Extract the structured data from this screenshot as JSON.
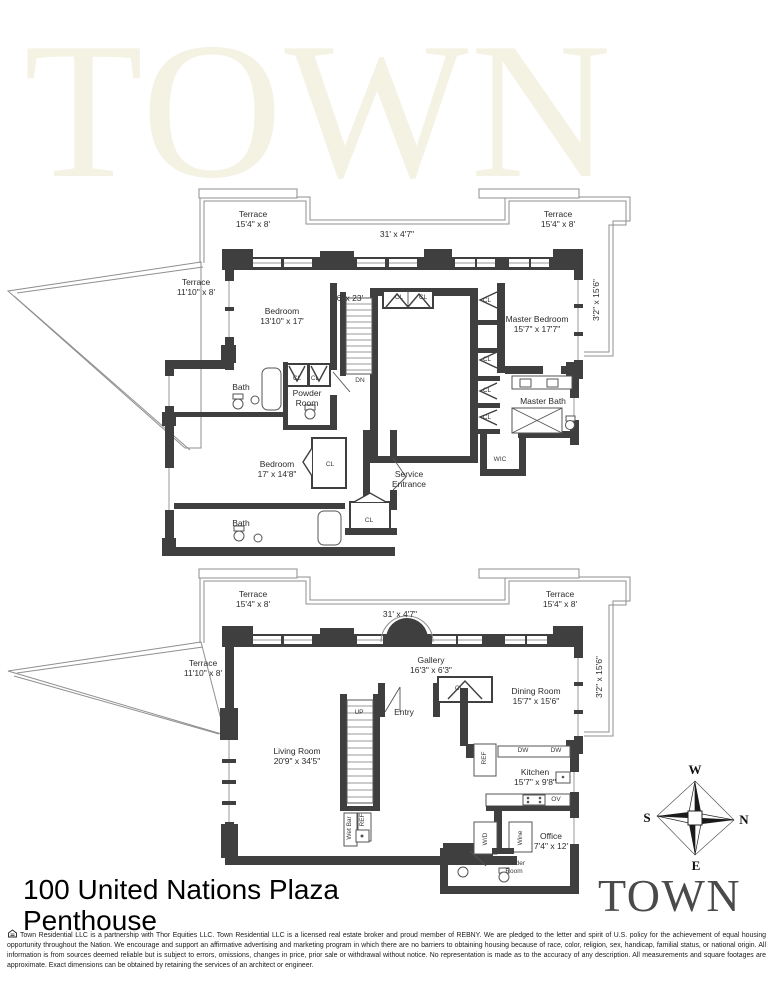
{
  "watermark": "TOWN",
  "colors": {
    "wall": "#3f3f3f",
    "outline": "#8f8f8f",
    "watermark": "#f4f2e3",
    "logo": "#4a4a4a"
  },
  "compass": {
    "top": "W",
    "left": "S",
    "right": "N",
    "bottom": "E"
  },
  "footer": {
    "address": "100 United Nations Plaza",
    "unit": "Penthouse",
    "logo": "TOWN",
    "disclaimer": "Town Residential LLC is a partnership with Thor Equities LLC. Town Residential LLC is a licensed real estate broker and proud member of REBNY. We are pledged to the letter and spirit of U.S. policy for the achievement of equal housing opportunity throughout the Nation. We encourage and support an affirmative advertising and marketing program in which there are no barriers to obtaining housing because of race, color, religion, sex, handicap, familial status, or national origin. All information is from sources deemed reliable but is subject to errors, omissions, changes in price, prior sale or withdrawal without notice. No representation is made as to the accuracy of any description. All measurements and square footages are approximate. Exact dimensions can be obtained by retaining the services of an architect or engineer."
  },
  "floors": {
    "upper": {
      "labels": [
        {
          "text": "Terrace",
          "sub": "15'4\" x 8'",
          "x": 253,
          "y": 219
        },
        {
          "text": "31' x 4'7\"",
          "x": 397,
          "y": 234
        },
        {
          "text": "Terrace",
          "sub": "15'4\" x 8'",
          "x": 558,
          "y": 219
        },
        {
          "text": "Terrace",
          "sub": "11'10\" x 8'",
          "x": 196,
          "y": 287
        },
        {
          "text": "Bedroom",
          "sub": "13'10\" x 17'",
          "x": 282,
          "y": 316
        },
        {
          "text": "6' x 23'",
          "x": 350,
          "y": 298
        },
        {
          "text": "CL",
          "x": 399,
          "y": 298,
          "small": true
        },
        {
          "text": "CL",
          "x": 423,
          "y": 298,
          "small": true
        },
        {
          "text": "CL",
          "x": 487,
          "y": 301,
          "small": true
        },
        {
          "text": "Master Bedroom",
          "sub": "15'7\" x 17'7\"",
          "x": 537,
          "y": 324
        },
        {
          "text": "3'2\" x 15'6\"",
          "x": 596,
          "y": 300,
          "rot": true
        },
        {
          "text": "CL",
          "x": 487,
          "y": 360,
          "small": true
        },
        {
          "text": "CL",
          "x": 487,
          "y": 391,
          "small": true
        },
        {
          "text": "CL",
          "x": 487,
          "y": 418,
          "small": true
        },
        {
          "text": "Master Bath",
          "x": 543,
          "y": 401
        },
        {
          "text": "WIC",
          "x": 500,
          "y": 460,
          "small": true
        },
        {
          "text": "Bath",
          "x": 241,
          "y": 387
        },
        {
          "text": "CL",
          "x": 297,
          "y": 379,
          "small": true
        },
        {
          "text": "CL",
          "x": 315,
          "y": 379,
          "small": true
        },
        {
          "text": "Powder",
          "sub": "Room",
          "x": 307,
          "y": 398
        },
        {
          "text": "DN",
          "x": 360,
          "y": 381,
          "small": true
        },
        {
          "text": "Bedroom",
          "sub": "17' x 14'8\"",
          "x": 277,
          "y": 469
        },
        {
          "text": "CL",
          "x": 330,
          "y": 465,
          "small": true
        },
        {
          "text": "Service",
          "sub": "Entrance",
          "x": 409,
          "y": 479
        },
        {
          "text": "CL",
          "x": 369,
          "y": 521,
          "small": true
        },
        {
          "text": "Bath",
          "x": 241,
          "y": 523
        }
      ]
    },
    "lower": {
      "labels": [
        {
          "text": "Terrace",
          "sub": "15'4\" x 8'",
          "x": 253,
          "y": 599
        },
        {
          "text": "31' x 4'7\"",
          "x": 400,
          "y": 614
        },
        {
          "text": "Terrace",
          "sub": "15'4\" x 8'",
          "x": 560,
          "y": 599
        },
        {
          "text": "Terrace",
          "sub": "11'10\" x 8'",
          "x": 203,
          "y": 668
        },
        {
          "text": "Gallery",
          "sub": "16'3\" x 6'3\"",
          "x": 431,
          "y": 665
        },
        {
          "text": "CL",
          "x": 459,
          "y": 689,
          "small": true
        },
        {
          "text": "Entry",
          "x": 404,
          "y": 712
        },
        {
          "text": "UP",
          "x": 359,
          "y": 713,
          "small": true
        },
        {
          "text": "Living Room",
          "sub": "20'9\" x 34'5\"",
          "x": 297,
          "y": 756
        },
        {
          "text": "Dining Room",
          "sub": "15'7\" x 15'6\"",
          "x": 536,
          "y": 696
        },
        {
          "text": "3'2\" x 15'6\"",
          "x": 599,
          "y": 677,
          "rot": true
        },
        {
          "text": "DW",
          "x": 523,
          "y": 751,
          "small": true
        },
        {
          "text": "DW",
          "x": 556,
          "y": 751,
          "small": true
        },
        {
          "text": "REF",
          "x": 485,
          "y": 758,
          "small": true,
          "rot": true
        },
        {
          "text": "Kitchen",
          "sub": "15'7\" x 9'8\"",
          "x": 535,
          "y": 777
        },
        {
          "text": "OV",
          "x": 556,
          "y": 800,
          "small": true
        },
        {
          "text": "W/D",
          "x": 486,
          "y": 839,
          "small": true,
          "rot": true
        },
        {
          "text": "Wine",
          "x": 521,
          "y": 838,
          "small": true,
          "rot": true
        },
        {
          "text": "Office",
          "sub": "7'4\" x 12'",
          "x": 551,
          "y": 841
        },
        {
          "text": "Powder",
          "sub": "Room",
          "x": 514,
          "y": 868,
          "small": true
        },
        {
          "text": "Wet Bar",
          "x": 350,
          "y": 828,
          "small": true,
          "rot": true
        },
        {
          "text": "REF",
          "x": 363,
          "y": 820,
          "small": true,
          "rot": true
        }
      ]
    }
  }
}
